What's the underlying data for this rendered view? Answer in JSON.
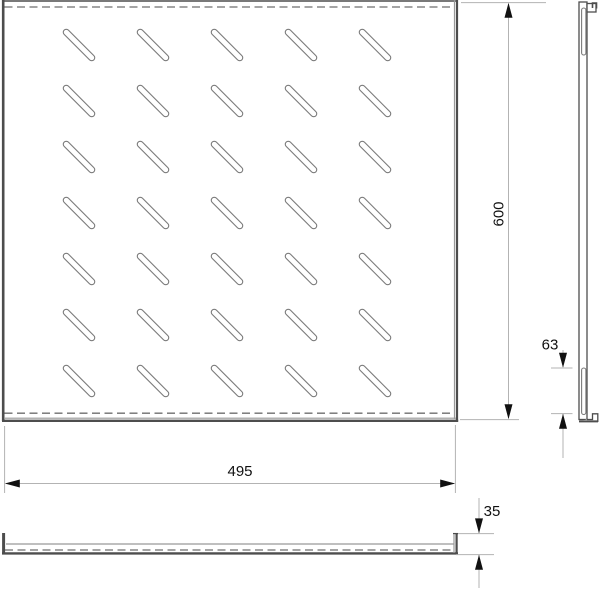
{
  "drawing": {
    "type": "technical-drawing",
    "part": "perforated rack shelf",
    "dimensions": {
      "overall_depth": {
        "value": "600"
      },
      "overall_width": {
        "value": "495"
      },
      "side_slot_length": {
        "value": "63"
      },
      "front_lip_height": {
        "value": "35"
      }
    },
    "top_view": {
      "slot_rows": 7,
      "slot_cols": 5
    },
    "side_view": {
      "slot_count": 2
    },
    "colors": {
      "edge": "#4d4d4d",
      "fold_line": "#999999",
      "slot_stroke": "#7a7a7a",
      "dashed_bend": "#6e6e6e",
      "dimension_line": "#b3b3b3",
      "arrow_and_text": "#111111",
      "background": "#ffffff"
    }
  }
}
